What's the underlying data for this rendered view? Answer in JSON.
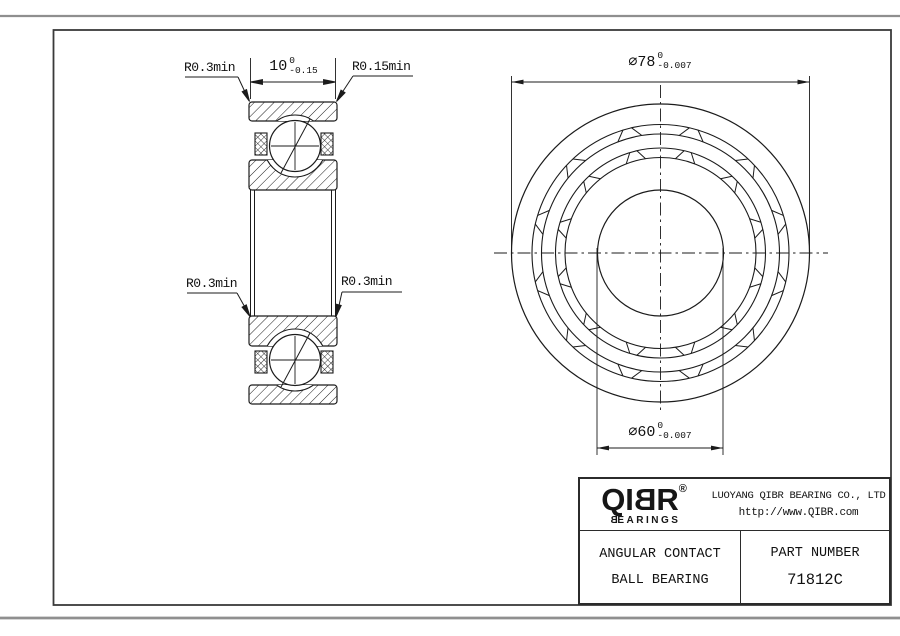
{
  "colors": {
    "line": "#1b1b1b",
    "frame": "#3a3a3a",
    "window_chrome": "#8f8f8f",
    "background": "#ffffff",
    "text": "#111111"
  },
  "annotations": {
    "radius_top_left": "R0.3min",
    "radius_top_right": "R0.15min",
    "radius_bottom_left": "R0.3min",
    "radius_bottom_right": "R0.3min"
  },
  "dimensions": {
    "width": {
      "value": "10",
      "tol_upper": "0",
      "tol_lower": "-0.15"
    },
    "outer_diameter": {
      "value": "∅78",
      "tol_upper": "0",
      "tol_lower": "-0.007"
    },
    "bore_diameter": {
      "value": "∅60",
      "tol_upper": "0",
      "tol_lower": "-0.007"
    }
  },
  "title_block": {
    "logo": {
      "part1": "QI",
      "flipped_b": "B",
      "part2": "R",
      "registered": "®"
    },
    "wordmark": {
      "flipped_b": "B",
      "rest": "EARINGS"
    },
    "company": "LUOYANG QIBR BEARING CO., LTD",
    "website": "http://www.QIBR.com",
    "product_type_line1": "ANGULAR CONTACT",
    "product_type_line2": "BALL BEARING",
    "part_number_label": "PART NUMBER",
    "part_number": "71812C"
  }
}
